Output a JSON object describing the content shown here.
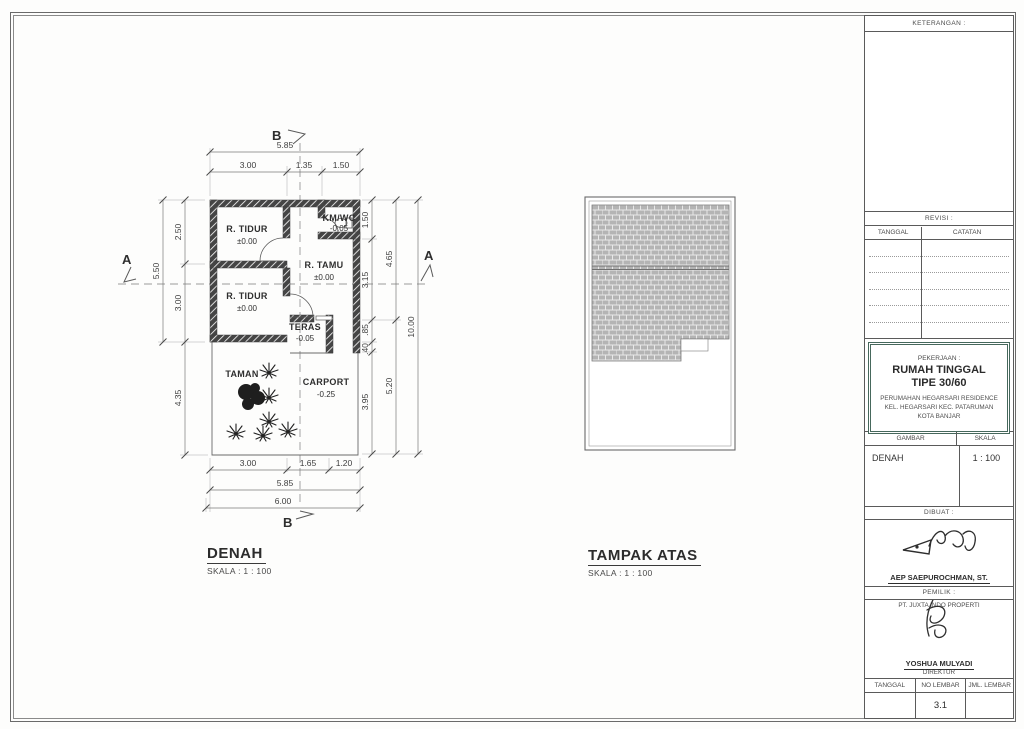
{
  "colors": {
    "line": "#5a5a5a",
    "wall_fill": "#454545",
    "roof_fill": "#b4b4b4",
    "pekerjaan_box_border": "#46685c"
  },
  "denah": {
    "title": "DENAH",
    "scale": "SKALA : 1 : 100",
    "markers": {
      "a": "A",
      "b": "B"
    },
    "rooms": [
      {
        "name": "R. TIDUR",
        "elev": "±0.00"
      },
      {
        "name": "KM/WC",
        "elev": "-0.05"
      },
      {
        "name": "R. TAMU",
        "elev": "±0.00"
      },
      {
        "name": "R. TIDUR",
        "elev": "±0.00"
      },
      {
        "name": "TERAS",
        "elev": "-0.05"
      },
      {
        "name": "TAMAN",
        "elev": ""
      },
      {
        "name": "CARPORT",
        "elev": "-0.25"
      }
    ],
    "dims": {
      "top_segments": [
        "3.00",
        "1.35",
        "1.50"
      ],
      "top_total": "5.85",
      "left_segments": [
        "2.50",
        "3.00"
      ],
      "left_total": "5.50",
      "left_lower": "4.35",
      "right_segments": [
        "1.50",
        "3.15",
        ".85",
        ".40",
        "3.95"
      ],
      "right_totals": [
        "4.65",
        "5.20"
      ],
      "right_overall": "10.00",
      "bottom_segments": [
        "3.00",
        "1.65",
        "1.20"
      ],
      "bottom_total": "5.85",
      "bottom_overall": "6.00"
    }
  },
  "tampak": {
    "title": "TAMPAK ATAS",
    "scale": "SKALA : 1 : 100"
  },
  "titleblock": {
    "keterangan_label": "KETERANGAN :",
    "revisi_label": "REVISI :",
    "tanggal_label": "TANGGAL",
    "catatan_label": "CATATAN",
    "pekerjaan_label": "PEKERJAAN :",
    "project_title_line1": "RUMAH TINGGAL",
    "project_title_line2": "TIPE 30/60",
    "project_addr_line1": "PERUMAHAN HEGARSARI RESIDENCE",
    "project_addr_line2": "KEL. HEGARSARI KEC. PATARUMAN",
    "project_addr_line3": "KOTA BANJAR",
    "gambar_label": "GAMBAR",
    "skala_label": "SKALA",
    "gambar_value": "DENAH",
    "skala_value": "1 : 100",
    "dibuat_label": "DIBUAT :",
    "dibuat_name": "AEP SAEPUROCHMAN, ST.",
    "pemilik_label": "PEMILIK :",
    "pemilik_company": "PT. JUXTA INDO PROPERTI",
    "pemilik_name": "YOSHUA MULYADI",
    "pemilik_title": "DIREKTUR",
    "bottom_cols": [
      "TANGGAL",
      "NO LEMBAR",
      "JML. LEMBAR"
    ],
    "no_lembar_value": "3.1"
  }
}
